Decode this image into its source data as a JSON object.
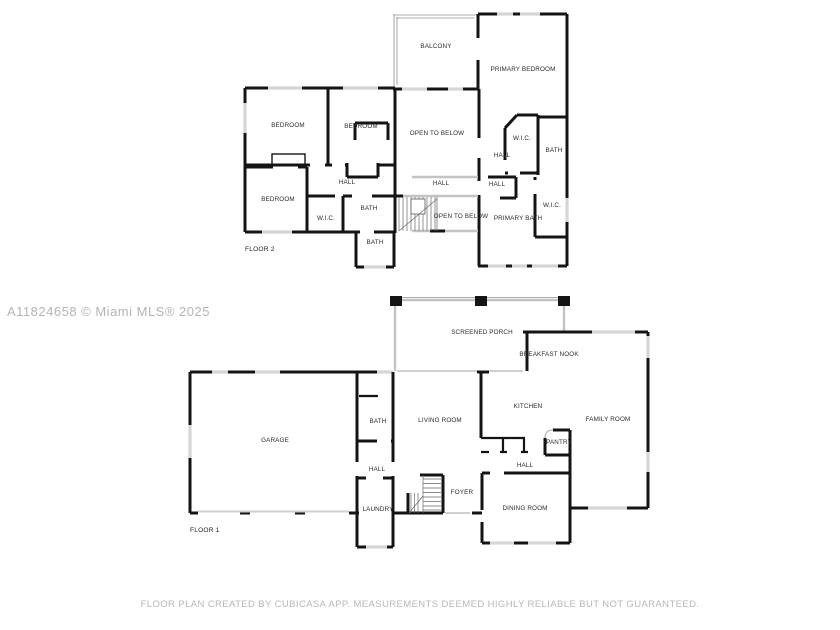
{
  "watermark": "A11824658 © Miami MLS® 2025",
  "footer": "FLOOR PLAN CREATED BY CUBICASA APP. MEASUREMENTS DEEMED HIGHLY RELIABLE BUT NOT GUARANTEED.",
  "colors": {
    "wall": "#141414",
    "window": "#d6d6d6",
    "railing": "#c3c3c3",
    "label": "#2b2b2b",
    "muted_text": "#b4b4b4"
  },
  "floor2": {
    "name": "FLOOR 2",
    "label_x": 245,
    "label_y": 251,
    "rooms": [
      {
        "t": "BALCONY",
        "x": 436,
        "y": 48
      },
      {
        "t": "PRIMARY BEDROOM",
        "x": 523,
        "y": 71
      },
      {
        "t": "BEDROOM",
        "x": 288,
        "y": 127
      },
      {
        "t": "BEDROOM",
        "x": 361,
        "y": 128
      },
      {
        "t": "OPEN TO BELOW",
        "x": 437,
        "y": 135
      },
      {
        "t": "W.I.C.",
        "x": 522,
        "y": 140
      },
      {
        "t": "HALL",
        "x": 502,
        "y": 157
      },
      {
        "t": "BATH",
        "x": 554,
        "y": 152
      },
      {
        "t": "HALL",
        "x": 347,
        "y": 184
      },
      {
        "t": "HALL",
        "x": 441,
        "y": 185
      },
      {
        "t": "HALL",
        "x": 497,
        "y": 186
      },
      {
        "t": "BEDROOM",
        "x": 278,
        "y": 201
      },
      {
        "t": "W.I.C.",
        "x": 326,
        "y": 220
      },
      {
        "t": "BATH",
        "x": 369,
        "y": 210
      },
      {
        "t": "OPEN TO BELOW",
        "x": 461,
        "y": 218
      },
      {
        "t": "PRIMARY BATH",
        "x": 518,
        "y": 220
      },
      {
        "t": "W.I.C.",
        "x": 552,
        "y": 207
      },
      {
        "t": "BATH",
        "x": 375,
        "y": 244
      }
    ]
  },
  "floor1": {
    "name": "FLOOR 1",
    "label_x": 190,
    "label_y": 532,
    "rooms": [
      {
        "t": "SCREENED PORCH",
        "x": 482,
        "y": 334
      },
      {
        "t": "BREAKFAST NOOK",
        "x": 549,
        "y": 356
      },
      {
        "t": "GARAGE",
        "x": 275,
        "y": 442
      },
      {
        "t": "BATH",
        "x": 378,
        "y": 423
      },
      {
        "t": "LIVING ROOM",
        "x": 440,
        "y": 422
      },
      {
        "t": "KITCHEN",
        "x": 528,
        "y": 408
      },
      {
        "t": "FAMILY ROOM",
        "x": 608,
        "y": 421
      },
      {
        "t": "PANTRY",
        "x": 559,
        "y": 444
      },
      {
        "t": "HALL",
        "x": 377,
        "y": 471
      },
      {
        "t": "HALL",
        "x": 525,
        "y": 467
      },
      {
        "t": "FOYER",
        "x": 462,
        "y": 494
      },
      {
        "t": "LAUNDRY",
        "x": 378,
        "y": 511
      },
      {
        "t": "DINING ROOM",
        "x": 525,
        "y": 510
      }
    ]
  }
}
